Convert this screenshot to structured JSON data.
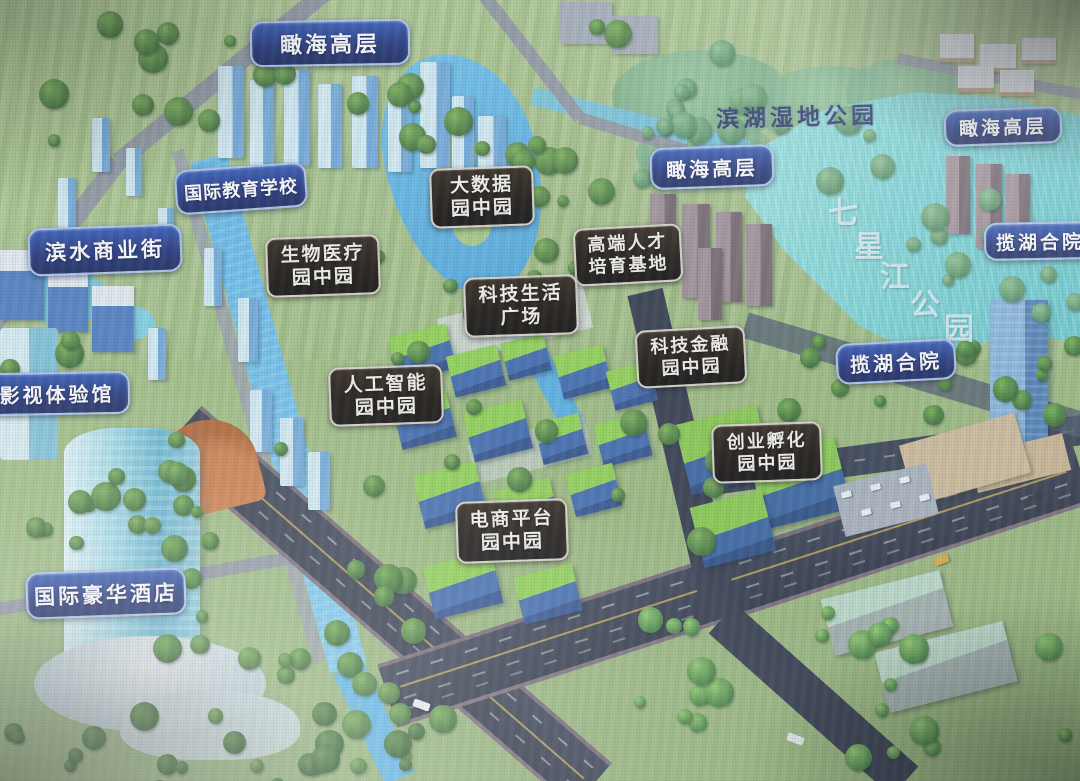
{
  "image_type": "photographed screen of an aerial master-plan rendering",
  "map": {
    "labels": [
      {
        "id": "kanhai-top",
        "type": "blue-pill",
        "text": "瞰海高层"
      },
      {
        "id": "binhu-wetland-park",
        "type": "plain-text",
        "text": "滨湖湿地公园"
      },
      {
        "id": "kanhai-mid",
        "type": "blue-pill",
        "text": "瞰海高层"
      },
      {
        "id": "kanhai-right",
        "type": "blue-pill",
        "text": "瞰海高层"
      },
      {
        "id": "lanhu-right",
        "type": "blue-pill",
        "text": "揽湖合院"
      },
      {
        "id": "intl-education-school",
        "type": "blue-pill",
        "text": "国际教育学校"
      },
      {
        "id": "big-data-park",
        "type": "black-plaque",
        "line1": "大数据",
        "line2": "园中园"
      },
      {
        "id": "binshui-commercial-street",
        "type": "blue-pill",
        "text": "滨水商业街"
      },
      {
        "id": "bio-medical-park",
        "type": "black-plaque",
        "line1": "生物医疗",
        "line2": "园中园"
      },
      {
        "id": "talent-cultivation-base",
        "type": "black-plaque",
        "line1": "高端人才",
        "line2": "培育基地"
      },
      {
        "id": "tech-life-plaza",
        "type": "black-plaque",
        "line1": "科技生活",
        "line2": "广场"
      },
      {
        "id": "tech-finance-park",
        "type": "black-plaque",
        "line1": "科技金融",
        "line2": "园中园"
      },
      {
        "id": "lanhu-mid",
        "type": "blue-pill",
        "text": "揽湖合院"
      },
      {
        "id": "film-tv-experience-hall",
        "type": "blue-pill",
        "text": "影视体验馆"
      },
      {
        "id": "ai-park",
        "type": "black-plaque",
        "line1": "人工智能",
        "line2": "园中园"
      },
      {
        "id": "startup-incubation-park",
        "type": "black-plaque",
        "line1": "创业孵化",
        "line2": "园中园"
      },
      {
        "id": "ecommerce-platform-park",
        "type": "black-plaque",
        "line1": "电商平台",
        "line2": "园中园"
      },
      {
        "id": "intl-luxury-hotel",
        "type": "blue-pill",
        "text": "国际豪华酒店"
      },
      {
        "id": "qixingjiang-park",
        "type": "water-text",
        "text": "七星江公园"
      }
    ],
    "colors": {
      "pill_blue": "#1c3078",
      "pill_blue_border": "#a9c3ee",
      "plaque_black": "#150f08",
      "plaque_border": "#d8d2c6",
      "label_text": "#ffffff",
      "plain_label_text": "#1d2f63",
      "water_label_text": "#ebf6fa",
      "lake_water": "#74d2d2",
      "canal_water": "#5fb7e7",
      "grass": "#9cba7c",
      "road_dark": "#2b3140",
      "road_grey": "#8f969f",
      "campus_roof_green": "#8ed24f",
      "campus_body_blue": "#3c68ad"
    }
  }
}
